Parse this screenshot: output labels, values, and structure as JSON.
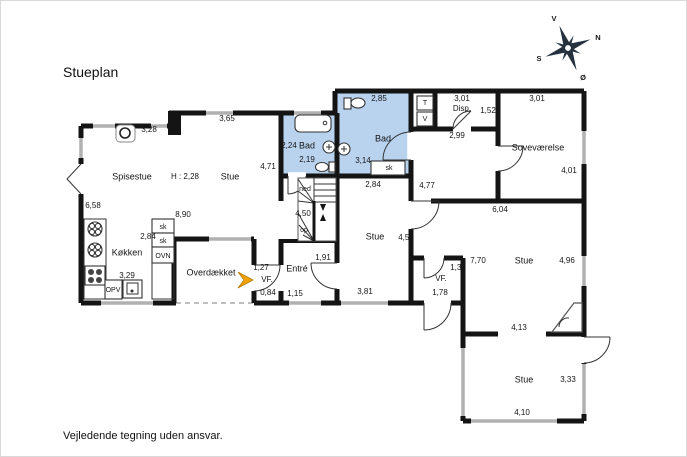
{
  "title": "Stueplan",
  "footer": "Vejledende tegning uden ansvar.",
  "colors": {
    "wall": "#141414",
    "window": "#b1b1b1",
    "bath_floor": "#b9d3ef",
    "entrance_arrow": "#f0a30a",
    "overhang_dash": "#aaaaaa",
    "compass_dark": "#26313f"
  },
  "labels": [
    {
      "t": "Spisestue",
      "x": 131,
      "y": 176,
      "c": "room",
      "n": "room-label-spisestue"
    },
    {
      "t": "Stue",
      "x": 229,
      "y": 176,
      "c": "room",
      "n": "room-label-stue-west"
    },
    {
      "t": "H : 2,28",
      "x": 184,
      "y": 176,
      "c": "dim",
      "n": "ceiling-height-note"
    },
    {
      "t": "Køkken",
      "x": 126,
      "y": 252,
      "c": "room",
      "n": "room-label-koekken"
    },
    {
      "t": "Bad",
      "x": 306,
      "y": 145,
      "c": "room",
      "n": "room-label-bad-west"
    },
    {
      "t": "Bad",
      "x": 382,
      "y": 138,
      "c": "room",
      "n": "room-label-bad-east"
    },
    {
      "t": "Soveværelse",
      "x": 537,
      "y": 147,
      "c": "room",
      "n": "room-label-sovevaerelse"
    },
    {
      "t": "Disp.",
      "x": 461,
      "y": 108,
      "c": "dim",
      "n": "room-label-disp"
    },
    {
      "t": "Entré",
      "x": 296,
      "y": 268,
      "c": "room",
      "n": "room-label-entre"
    },
    {
      "t": "Overdækket",
      "x": 210,
      "y": 272,
      "c": "room",
      "n": "room-label-overdaekket"
    },
    {
      "t": "VF.",
      "x": 266,
      "y": 279,
      "c": "dim",
      "n": "room-label-vf-west"
    },
    {
      "t": "VF.",
      "x": 440,
      "y": 278,
      "c": "dim",
      "n": "room-label-vf-east"
    },
    {
      "t": "Stue",
      "x": 374,
      "y": 236,
      "c": "room",
      "n": "room-label-stue-center"
    },
    {
      "t": "Stue",
      "x": 523,
      "y": 260,
      "c": "room",
      "n": "room-label-stue-east"
    },
    {
      "t": "Stue",
      "x": 523,
      "y": 379,
      "c": "room",
      "n": "room-label-stue-south"
    },
    {
      "t": "3,28",
      "x": 148,
      "y": 129,
      "c": "dim",
      "n": "dim-3-28"
    },
    {
      "t": "3,65",
      "x": 226,
      "y": 118,
      "c": "dim",
      "n": "dim-3-65"
    },
    {
      "t": "2,85",
      "x": 378,
      "y": 98,
      "c": "dim",
      "n": "dim-2-85"
    },
    {
      "t": "3,01",
      "x": 461,
      "y": 98,
      "c": "dim",
      "n": "dim-3-01-disp"
    },
    {
      "t": "1,52",
      "x": 487,
      "y": 110,
      "c": "dim",
      "n": "dim-1-52"
    },
    {
      "t": "3,01",
      "x": 536,
      "y": 98,
      "c": "dim",
      "n": "dim-3-01-sove"
    },
    {
      "t": "2,99",
      "x": 456,
      "y": 135,
      "c": "dim",
      "n": "dim-2-99"
    },
    {
      "t": "4,71",
      "x": 267,
      "y": 166,
      "c": "dim",
      "n": "dim-4-71"
    },
    {
      "t": "2,24",
      "x": 288,
      "y": 145,
      "c": "dim",
      "n": "dim-2-24"
    },
    {
      "t": "2,19",
      "x": 306,
      "y": 159,
      "c": "dim",
      "n": "dim-2-19"
    },
    {
      "t": "3,14",
      "x": 362,
      "y": 160,
      "c": "dim",
      "n": "dim-3-14"
    },
    {
      "t": "2,84",
      "x": 372,
      "y": 184,
      "c": "dim",
      "n": "dim-2-84-bad"
    },
    {
      "t": "4,77",
      "x": 426,
      "y": 185,
      "c": "dim",
      "n": "dim-4-77"
    },
    {
      "t": "4,01",
      "x": 568,
      "y": 170,
      "c": "dim",
      "n": "dim-4-01"
    },
    {
      "t": "6,04",
      "x": 499,
      "y": 209,
      "c": "dim",
      "n": "dim-6-04"
    },
    {
      "t": "6,58",
      "x": 92,
      "y": 205,
      "c": "dim",
      "n": "dim-6-58"
    },
    {
      "t": "8,90",
      "x": 182,
      "y": 214,
      "c": "dim",
      "n": "dim-8-90"
    },
    {
      "t": "2,84",
      "x": 147,
      "y": 236,
      "c": "dim",
      "n": "dim-2-84-koekken"
    },
    {
      "t": "4,54",
      "x": 405,
      "y": 237,
      "c": "dim",
      "n": "dim-4-54"
    },
    {
      "t": "3,29",
      "x": 126,
      "y": 275,
      "c": "dim",
      "n": "dim-3-29"
    },
    {
      "t": "4,50",
      "x": 302,
      "y": 213,
      "c": "dim",
      "n": "dim-4-50"
    },
    {
      "t": "1,91",
      "x": 322,
      "y": 257,
      "c": "dim",
      "n": "dim-1-91"
    },
    {
      "t": "1,27",
      "x": 260,
      "y": 267,
      "c": "dim",
      "n": "dim-1-27"
    },
    {
      "t": "0,84",
      "x": 267,
      "y": 292,
      "c": "dim",
      "n": "dim-0-84"
    },
    {
      "t": "1,15",
      "x": 294,
      "y": 293,
      "c": "dim",
      "n": "dim-1-15"
    },
    {
      "t": "3,81",
      "x": 364,
      "y": 291,
      "c": "dim",
      "n": "dim-3-81"
    },
    {
      "t": "7,70",
      "x": 477,
      "y": 260,
      "c": "dim",
      "n": "dim-7-70"
    },
    {
      "t": "4,96",
      "x": 566,
      "y": 260,
      "c": "dim",
      "n": "dim-4-96"
    },
    {
      "t": "1,30",
      "x": 457,
      "y": 267,
      "c": "dim",
      "n": "dim-1-30"
    },
    {
      "t": "1,78",
      "x": 439,
      "y": 292,
      "c": "dim",
      "n": "dim-1-78"
    },
    {
      "t": "4,13",
      "x": 518,
      "y": 327,
      "c": "dim",
      "n": "dim-4-13"
    },
    {
      "t": "3,33",
      "x": 567,
      "y": 379,
      "c": "dim",
      "n": "dim-3-33"
    },
    {
      "t": "4,10",
      "x": 521,
      "y": 412,
      "c": "dim",
      "n": "dim-4-10"
    },
    {
      "t": "ned",
      "x": 304,
      "y": 188,
      "c": "small",
      "n": "stairs-down-label"
    },
    {
      "t": "op",
      "x": 303,
      "y": 229,
      "c": "small",
      "n": "stairs-up-label"
    },
    {
      "t": "sk",
      "x": 388,
      "y": 167,
      "c": "small",
      "n": "closet-label-bad"
    },
    {
      "t": "sk",
      "x": 162,
      "y": 226,
      "c": "small",
      "n": "closet-label-1"
    },
    {
      "t": "sk",
      "x": 162,
      "y": 240,
      "c": "small",
      "n": "closet-label-2"
    },
    {
      "t": "OVN",
      "x": 162,
      "y": 255,
      "c": "small",
      "n": "oven-label"
    },
    {
      "t": "OPV",
      "x": 112,
      "y": 289,
      "c": "small",
      "n": "dishwasher-label"
    },
    {
      "t": "T",
      "x": 424,
      "y": 102,
      "c": "small",
      "n": "dryer-label"
    },
    {
      "t": "V",
      "x": 424,
      "y": 118,
      "c": "small",
      "n": "washer-label"
    },
    {
      "t": "V",
      "x": 553,
      "y": 18,
      "c": "compass",
      "n": "compass-west-letter"
    },
    {
      "t": "N",
      "x": 597,
      "y": 37,
      "c": "compass",
      "n": "compass-north-letter"
    },
    {
      "t": "S",
      "x": 538,
      "y": 58,
      "c": "compass",
      "n": "compass-south-letter"
    },
    {
      "t": "Ø",
      "x": 582,
      "y": 77,
      "c": "compass",
      "n": "compass-east-letter"
    }
  ]
}
